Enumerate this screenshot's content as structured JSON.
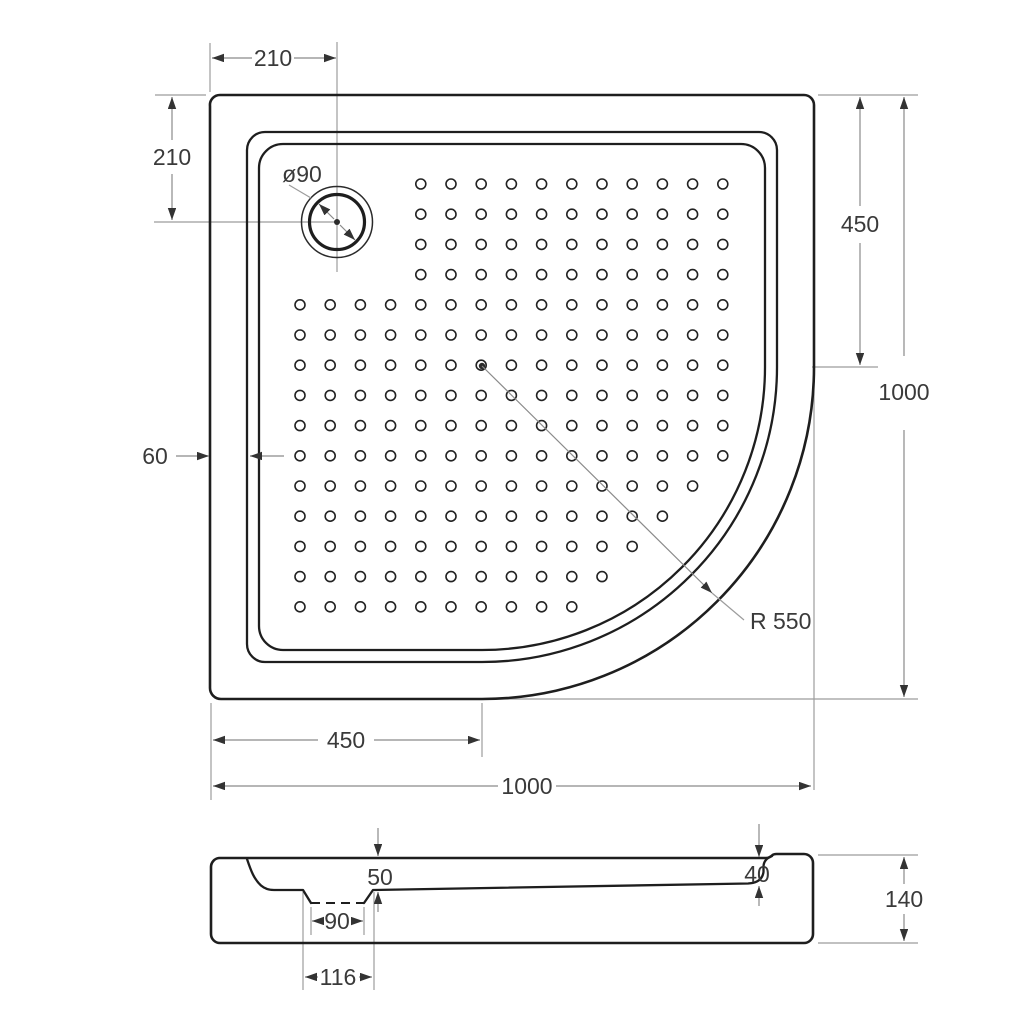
{
  "drawing": {
    "subject": "quadrant shower tray technical drawing",
    "colors": {
      "background": "#ffffff",
      "outline": "#1e1e1e",
      "dimension_lines": "#8a8a8a",
      "text": "#3a3a3a"
    }
  },
  "top_view": {
    "dim_drain_offset_x": "210",
    "dim_drain_offset_y": "210",
    "drain_label": "ø90",
    "dim_side_straight": "450",
    "dim_overall_height": "1000",
    "dim_rim_width": "60",
    "corner_radius_label": "R 550",
    "dim_bottom_straight": "450",
    "dim_overall_width": "1000",
    "dot_grid": {
      "origin_x": 300,
      "origin_y": 184,
      "step": 30.2,
      "dot_radius": 5,
      "rows": [
        {
          "from": 4,
          "to": 14
        },
        {
          "from": 4,
          "to": 14
        },
        {
          "from": 4,
          "to": 14
        },
        {
          "from": 4,
          "to": 14
        },
        {
          "from": 0,
          "to": 14
        },
        {
          "from": 0,
          "to": 14
        },
        {
          "from": 0,
          "to": 14
        },
        {
          "from": 0,
          "to": 14
        },
        {
          "from": 0,
          "to": 14
        },
        {
          "from": 0,
          "to": 14
        },
        {
          "from": 0,
          "to": 13
        },
        {
          "from": 0,
          "to": 12
        },
        {
          "from": 0,
          "to": 11
        },
        {
          "from": 0,
          "to": 10
        },
        {
          "from": 0,
          "to": 9
        }
      ]
    }
  },
  "section_view": {
    "dim_basin_depth": "50",
    "dim_drain_hole": "90",
    "dim_drain_recess": "116",
    "dim_front_rim": "40",
    "dim_overall_height": "140"
  }
}
